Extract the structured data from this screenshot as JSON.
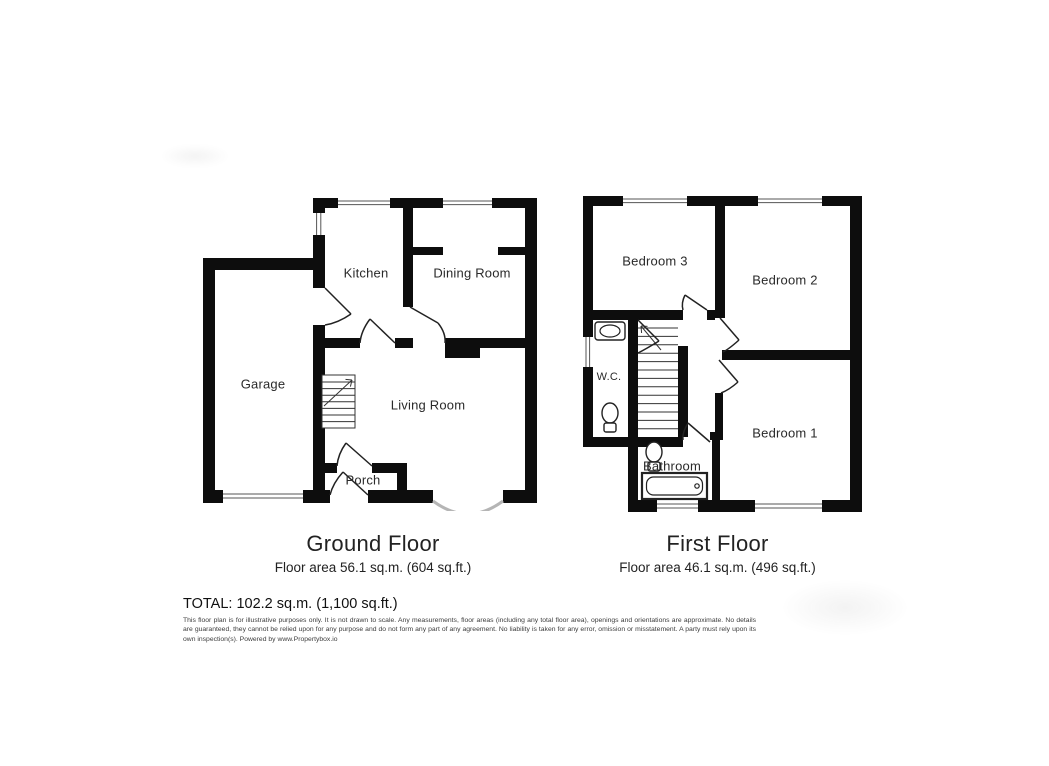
{
  "ground_floor": {
    "title": "Ground Floor",
    "area_text": "Floor area 56.1 sq.m. (604 sq.ft.)",
    "rooms": {
      "kitchen": "Kitchen",
      "dining_room": "Dining Room",
      "garage": "Garage",
      "living_room": "Living Room",
      "porch": "Porch"
    }
  },
  "first_floor": {
    "title": "First Floor",
    "area_text": "Floor area 46.1 sq.m. (496 sq.ft.)",
    "rooms": {
      "bedroom_3": "Bedroom 3",
      "bedroom_2": "Bedroom 2",
      "bedroom_1": "Bedroom 1",
      "wc": "W.C.",
      "bathroom": "Bathroom"
    }
  },
  "summary": {
    "total_text": "TOTAL: 102.2 sq.m. (1,100 sq.ft.)"
  },
  "disclaimer": "This floor plan is for illustrative purposes only. It is not drawn to scale. Any measurements, floor areas (including any total floor area), openings and orientations are approximate. No details are guaranteed, they cannot be relied upon for any purpose and do not form any part of any agreement. No liability is taken for any error, omission or misstatement. A party must rely upon its own inspection(s). Powered by www.Propertybox.io",
  "colors": {
    "wall": "#0d0d0d",
    "door_line": "#222222",
    "window_line": "#555555",
    "bay_arc": "#b5b5b5",
    "stair_line": "#333333",
    "label_text": "#2a2a2a"
  }
}
